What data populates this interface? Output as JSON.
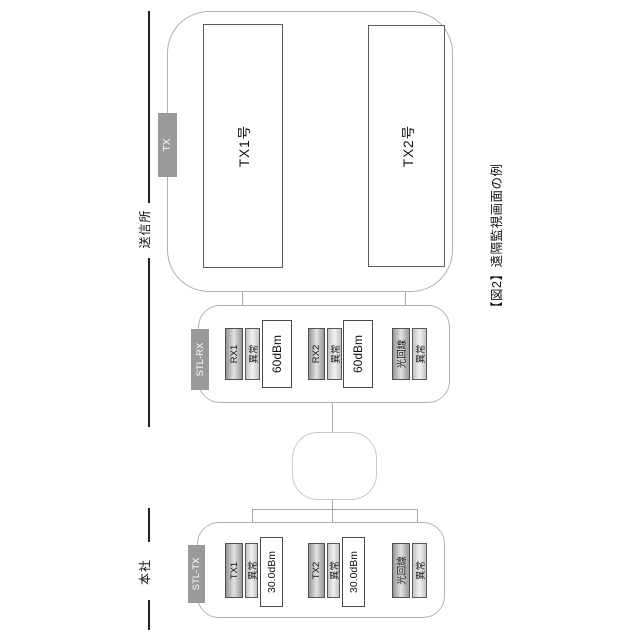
{
  "figure": {
    "caption": "【図2】遠隔監視画面の例"
  },
  "boundary": {
    "left_label": "本社",
    "right_label": "送信所"
  },
  "station": {
    "antenna_badge": "TX",
    "transmitters": [
      {
        "label": "TX1号"
      },
      {
        "label": "TX2号"
      }
    ]
  },
  "stl_rx": {
    "badge": "STL-RX",
    "groups": [
      {
        "name": "RX1",
        "status": "異常",
        "level": "60dBm"
      },
      {
        "name": "RX2",
        "status": "異常",
        "level": "60dBm"
      },
      {
        "name": "光回線",
        "status": "異常"
      }
    ]
  },
  "stl_tx": {
    "badge": "STL-TX",
    "groups": [
      {
        "name": "TX1",
        "status": "異常",
        "level": "30.0dBm"
      },
      {
        "name": "TX2",
        "status": "異常",
        "level": "30.0dBm"
      },
      {
        "name": "光回線",
        "status": "異常"
      }
    ]
  },
  "colors": {
    "badge_gray": "#9a9a9a",
    "boundary_black": "#222222",
    "frame_gray": "#b2b2b2",
    "connector_gray": "#a9a9a9"
  }
}
